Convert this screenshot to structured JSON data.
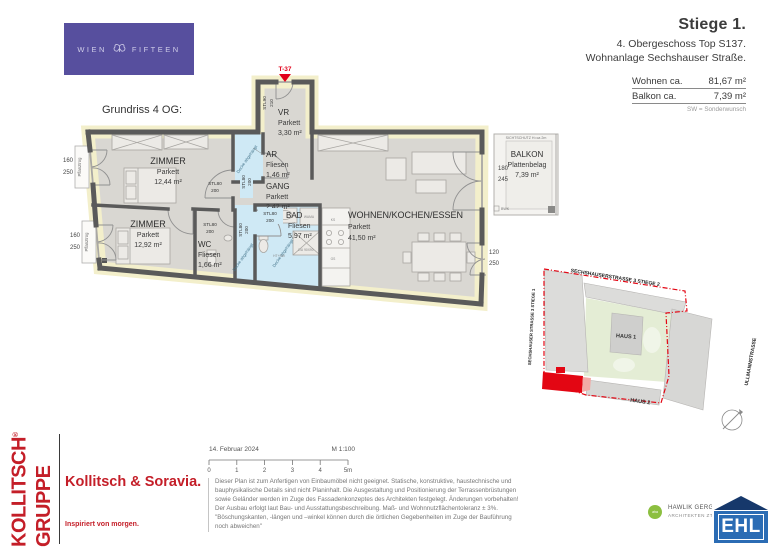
{
  "brand": {
    "wien": "WIEN",
    "fifteen": "FIFTEEN"
  },
  "header": {
    "title": "Stiege 1.",
    "subtitle": "4. Obergeschoss Top S137.",
    "project": "Wohnanlage Sechshauser Straße.",
    "rows": [
      {
        "label": "Wohnen ca.",
        "value": "81,67 m²"
      },
      {
        "label": "Balkon ca.",
        "value": "7,39 m²"
      }
    ],
    "note": "SW = Sonderwunsch"
  },
  "plan": {
    "caption": "Grundriss 4 OG:",
    "entry_tag": "T-37",
    "rooms": [
      {
        "name": "ZIMMER",
        "material": "Parkett",
        "area": "12,44 m²"
      },
      {
        "name": "ZIMMER",
        "material": "Parkett",
        "area": "12,92 m²"
      },
      {
        "name": "WC",
        "material": "Fliesen",
        "area": "1,66 m²"
      },
      {
        "name": "BAD",
        "material": "Fliesen",
        "area": "5,97 m²"
      },
      {
        "name": "GANG",
        "material": "Parkett",
        "area": "2,42 m²"
      },
      {
        "name": "AR",
        "material": "Fliesen",
        "area": "1,46 m²"
      },
      {
        "name": "VR",
        "material": "Parkett",
        "area": "3,30 m²"
      },
      {
        "name": "WOHNEN/KOCHEN/ESSEN",
        "material": "Parkett",
        "area": "41,50 m²"
      },
      {
        "name": "BALKON",
        "material": "Plattenbelag",
        "area": "7,39 m²"
      }
    ],
    "labels": {
      "stl80": "STL80",
      "w200": "200",
      "stl90": "STL90",
      "w210": "210",
      "decke": "Decke abgehängt",
      "pflanztrog": "Pflanztrog",
      "sichtschutz": "SICHTSCHUTZ H=ca 2m",
      "bwk": "BWK",
      "wama": "WAMA",
      "du": "DU 90X90",
      "ks": "KS",
      "gs": "GS",
      "htsw": "HT+SW"
    },
    "dims": [
      {
        "w": "160",
        "h": "250"
      },
      {
        "w": "160",
        "h": "250"
      },
      {
        "w": "180",
        "h": "245"
      },
      {
        "w": "120",
        "h": "250"
      }
    ]
  },
  "siteplan": {
    "street_top": "SECHSHAUSERSTRASSE 3 STIEGE 2",
    "street_left": "SECHSHAUSER STRASSE 3 STIEGE 1",
    "street_right": "ULLMANNSTRASSE",
    "haus1": "HAUS 1",
    "haus2": "HAUS 2"
  },
  "footer": {
    "group_word1": "KOLLITSCH",
    "group_reg": "®",
    "group_word2": "GRUPPE",
    "brand": "Kollitsch & Soravia.",
    "slogan": "Inspiriert von morgen.",
    "date": "14. Februar 2024",
    "scale": "M 1:100",
    "ticks": [
      "0",
      "1",
      "2",
      "3",
      "4",
      "5m"
    ],
    "disclaimer_lines": [
      "Dieser Plan ist zum Anfertigen von  Einbaumöbel nicht geeignet. Statische,  konstruktive, haustechnische und",
      "bauphysikalische Details sind nicht Planinhalt. Die Ausgestaltung und Positionierung der Terrassenbrüstungen",
      "sowie Geländer werden im Zuge des Fassadenkonzeptes des Architekten festgelegt. Änderungen vorbehalten!",
      "Der Ausbau erfolgt laut Bau-  und Ausstattungsbeschreibung. Maß-  und Wohnnutzflächentoleranz ± 3%.",
      "\"Böschungskanten, -längen und –winkel können durch die örtlichen Gegebenheiten im Zuge der Bauführung",
      "noch abweichen\""
    ],
    "architect_line1": "HAWLIK GERGIN",
    "architect_line2": "ARCHITEKTEN ZT G",
    "architect_badge": "aha",
    "ehl": "EHL"
  },
  "colors": {
    "purple": "#574f9e",
    "brand_red": "#c41e28",
    "plan_red": "#e2001a",
    "ehl_blue": "#2b6cb4",
    "ehl_navy": "#16386b",
    "wet_room_blue": "#cfe9f5",
    "floor_gray": "#d9d7d2",
    "wall_gray": "#5a5a5a",
    "site_green": "#e4edd5"
  }
}
